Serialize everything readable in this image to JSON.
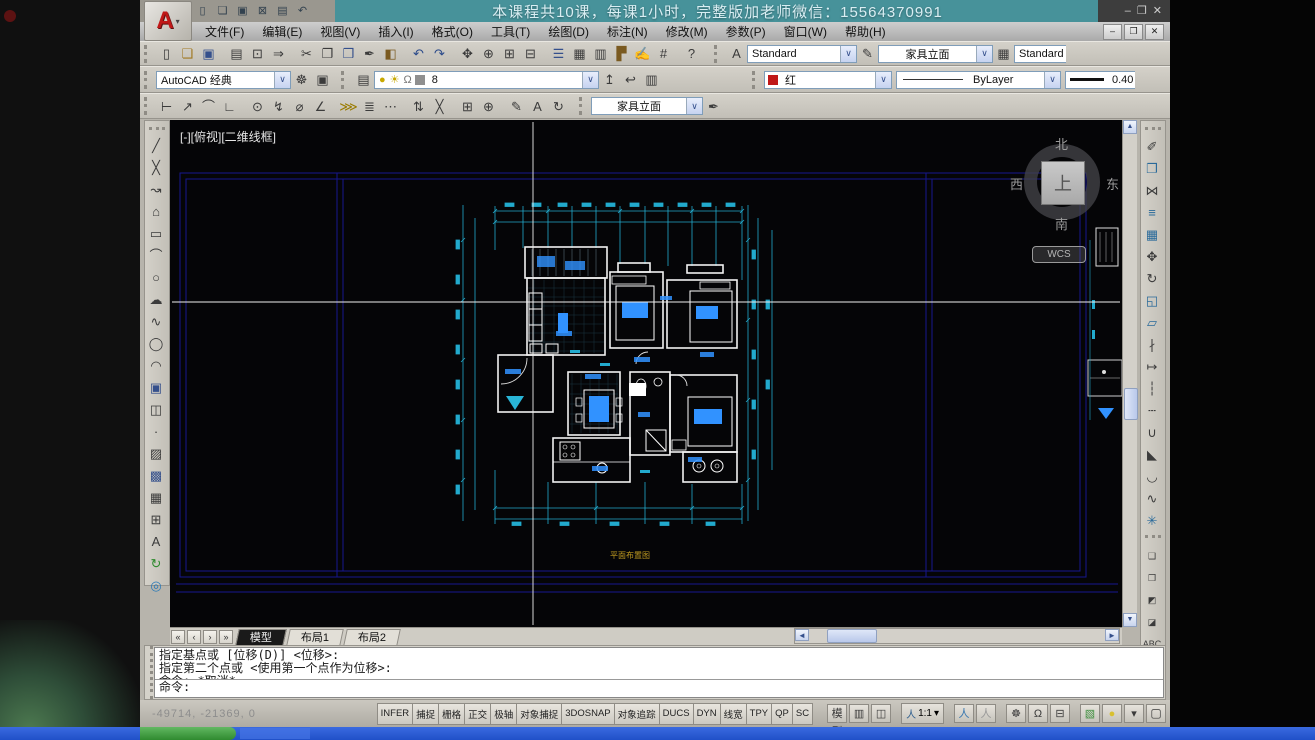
{
  "window": {
    "banner_text": "本课程共10课，每课1小时，完整版加老师微信：15564370991",
    "logo_letter": "A"
  },
  "icons": {
    "min": "–",
    "restore": "❐",
    "close": "✕",
    "combo_arrow": "∨",
    "dropdown": "▾",
    "text_style": "A",
    "dim_style": "✎",
    "table_style": "▦",
    "layer_mgr": "▤",
    "layer_bulb": "●",
    "layer_sun": "☀",
    "layer_lock": "Ω",
    "layer_current": "↥",
    "layer_prev": "↩",
    "layer_states": "▥",
    "workspace_gear": "☸",
    "workspace_save": "▣",
    "dim_style_mgr": "✒",
    "person": "人",
    "scroll_up": "▲",
    "scroll_down": "▼",
    "scroll_left": "◄",
    "scroll_right": "►"
  },
  "menu": {
    "items": [
      {
        "n": "menu-file",
        "t": "文件(F)"
      },
      {
        "n": "menu-edit",
        "t": "编辑(E)"
      },
      {
        "n": "menu-view",
        "t": "视图(V)"
      },
      {
        "n": "menu-insert",
        "t": "插入(I)"
      },
      {
        "n": "menu-format",
        "t": "格式(O)"
      },
      {
        "n": "menu-tools",
        "t": "工具(T)"
      },
      {
        "n": "menu-draw",
        "t": "绘图(D)"
      },
      {
        "n": "menu-dimension",
        "t": "标注(N)"
      },
      {
        "n": "menu-modify",
        "t": "修改(M)"
      },
      {
        "n": "menu-parametric",
        "t": "参数(P)"
      },
      {
        "n": "menu-window",
        "t": "窗口(W)"
      },
      {
        "n": "menu-help",
        "t": "帮助(H)"
      }
    ]
  },
  "qat": {
    "icons": [
      {
        "n": "qat-new-icon",
        "g": "▯"
      },
      {
        "n": "qat-open-icon",
        "g": "❏"
      },
      {
        "n": "qat-save-icon",
        "g": "▣"
      },
      {
        "n": "qat-saveas-icon",
        "g": "⊠"
      },
      {
        "n": "qat-plot-icon",
        "g": "▤"
      },
      {
        "n": "qat-undo-icon",
        "g": "↶"
      }
    ]
  },
  "toolbars": {
    "standard": [
      {
        "n": "new-icon",
        "g": "▯"
      },
      {
        "n": "open-icon",
        "g": "❏",
        "c": "#a07820"
      },
      {
        "n": "save-icon",
        "g": "▣",
        "c": "#35508c"
      },
      {
        "n": "plot-icon",
        "g": "▤",
        "gap": 1
      },
      {
        "n": "plot-preview-icon",
        "g": "⊡"
      },
      {
        "n": "publish-icon",
        "g": "⇒"
      },
      {
        "n": "cut-icon",
        "g": "✂",
        "gap": 1
      },
      {
        "n": "copy-icon",
        "g": "❐"
      },
      {
        "n": "paste-icon",
        "g": "❒",
        "c": "#35508c"
      },
      {
        "n": "match-properties-icon",
        "g": "✒"
      },
      {
        "n": "block-editor-icon",
        "g": "◧",
        "c": "#7a5a20"
      },
      {
        "n": "undo-icon",
        "g": "↶",
        "c": "#2a4a8a",
        "gap": 1
      },
      {
        "n": "redo-icon",
        "g": "↷",
        "c": "#2a4a8a"
      },
      {
        "n": "pan-icon",
        "g": "✥",
        "gap": 1
      },
      {
        "n": "zoom-realtime-icon",
        "g": "⊕"
      },
      {
        "n": "zoom-window-icon",
        "g": "⊞"
      },
      {
        "n": "zoom-previous-icon",
        "g": "⊟"
      },
      {
        "n": "properties-palette-icon",
        "g": "☰",
        "c": "#35508c",
        "gap": 1
      },
      {
        "n": "designcenter-icon",
        "g": "▦"
      },
      {
        "n": "tool-palettes-icon",
        "g": "▥"
      },
      {
        "n": "sheet-set-manager-icon",
        "g": "▛",
        "c": "#7a5a20"
      },
      {
        "n": "markup-sets-icon",
        "g": "✍"
      },
      {
        "n": "quickcalc-icon",
        "g": "#"
      },
      {
        "n": "help-icon",
        "g": "?",
        "gap": 1
      }
    ],
    "dim": [
      {
        "n": "dim-linear-icon",
        "g": "⊢"
      },
      {
        "n": "dim-aligned-icon",
        "g": "↗"
      },
      {
        "n": "dim-arc-length-icon",
        "g": "⌒"
      },
      {
        "n": "dim-ordinate-icon",
        "g": "∟"
      },
      {
        "n": "dim-radius-icon",
        "g": "⊙",
        "gap": 1
      },
      {
        "n": "dim-jogged-icon",
        "g": "↯"
      },
      {
        "n": "dim-diameter-icon",
        "g": "⌀"
      },
      {
        "n": "dim-angular-icon",
        "g": "∠"
      },
      {
        "n": "dim-quick-icon",
        "g": "⋙",
        "c": "#9a7b00",
        "gap": 1
      },
      {
        "n": "dim-baseline-icon",
        "g": "≣"
      },
      {
        "n": "dim-continue-icon",
        "g": "⋯"
      },
      {
        "n": "dim-space-icon",
        "g": "⇅",
        "gap": 1
      },
      {
        "n": "dim-break-icon",
        "g": "╳"
      },
      {
        "n": "dim-tolerance-icon",
        "g": "⊞",
        "gap": 1
      },
      {
        "n": "dim-center-mark-icon",
        "g": "⊕"
      },
      {
        "n": "dim-edit-icon",
        "g": "✎",
        "gap": 1
      },
      {
        "n": "dim-text-edit-icon",
        "g": "A"
      },
      {
        "n": "dim-update-icon",
        "g": "↻"
      }
    ],
    "draw": [
      {
        "n": "line-icon",
        "g": "╱"
      },
      {
        "n": "construction-line-icon",
        "g": "╳"
      },
      {
        "n": "polyline-icon",
        "g": "↝"
      },
      {
        "n": "polygon-icon",
        "g": "⌂"
      },
      {
        "n": "rectangle-icon",
        "g": "▭"
      },
      {
        "n": "arc-icon",
        "g": "⌒"
      },
      {
        "n": "circle-icon",
        "g": "○"
      },
      {
        "n": "revision-cloud-icon",
        "g": "☁"
      },
      {
        "n": "spline-icon",
        "g": "∿"
      },
      {
        "n": "ellipse-icon",
        "g": "◯"
      },
      {
        "n": "ellipse-arc-icon",
        "g": "◠"
      },
      {
        "n": "insert-block-icon",
        "g": "▣",
        "c": "#35508c"
      },
      {
        "n": "make-block-icon",
        "g": "◫"
      },
      {
        "n": "point-icon",
        "g": "·"
      },
      {
        "n": "hatch-icon",
        "g": "▨"
      },
      {
        "n": "gradient-icon",
        "g": "▩",
        "c": "#35508c"
      },
      {
        "n": "region-icon",
        "g": "▦"
      },
      {
        "n": "table-icon",
        "g": "⊞"
      },
      {
        "n": "mtext-icon",
        "g": "A"
      },
      {
        "n": "update-block-icon",
        "g": "↻",
        "c": "#2d8a2d"
      },
      {
        "n": "donut-icon",
        "g": "◎",
        "c": "#2a7ab8"
      }
    ],
    "modify": [
      {
        "n": "erase-icon",
        "g": "✐"
      },
      {
        "n": "copy-object-icon",
        "g": "❐",
        "c": "#2a6a9a"
      },
      {
        "n": "mirror-icon",
        "g": "⋈"
      },
      {
        "n": "offset-icon",
        "g": "≡",
        "c": "#2a6a9a"
      },
      {
        "n": "array-icon",
        "g": "▦",
        "c": "#2a6a9a"
      },
      {
        "n": "move-icon",
        "g": "✥"
      },
      {
        "n": "rotate-icon",
        "g": "↻"
      },
      {
        "n": "scale-icon",
        "g": "◱",
        "c": "#2a6a9a"
      },
      {
        "n": "stretch-icon",
        "g": "▱",
        "c": "#2a6a9a"
      },
      {
        "n": "trim-icon",
        "g": "∤"
      },
      {
        "n": "extend-icon",
        "g": "↦"
      },
      {
        "n": "break-at-point-icon",
        "g": "┆"
      },
      {
        "n": "break-icon",
        "g": "┄"
      },
      {
        "n": "join-icon",
        "g": "∪"
      },
      {
        "n": "chamfer-icon",
        "g": "◣"
      },
      {
        "n": "fillet-icon",
        "g": "◡"
      },
      {
        "n": "blend-curves-icon",
        "g": "∿"
      },
      {
        "n": "explode-icon",
        "g": "✳",
        "c": "#2a6a9a"
      }
    ],
    "draworder": [
      {
        "n": "bring-to-front-icon",
        "g": "❑"
      },
      {
        "n": "send-to-back-icon",
        "g": "❒"
      },
      {
        "n": "bring-above-icon",
        "g": "◩"
      },
      {
        "n": "send-under-icon",
        "g": "◪"
      },
      {
        "n": "text-to-front-icon",
        "g": "ABC",
        "cls": "txt"
      }
    ]
  },
  "styles": {
    "text_style_value": "Standard",
    "dim_style_value": "家具立面",
    "table_style_value": "Standard"
  },
  "workspace": {
    "value": "AutoCAD 经典"
  },
  "layers": {
    "current_layer": "8"
  },
  "props": {
    "color_value": "红",
    "color_hex": "#c01818",
    "linetype_value": "ByLayer",
    "lineweight_value": "0.40"
  },
  "dim": {
    "style_value": "家具立面"
  },
  "viewport": {
    "label": "[-][俯视][二维线框]"
  },
  "viewcube": {
    "north": "北",
    "south": "南",
    "east": "东",
    "west": "西",
    "up": "上",
    "wcs": "WCS"
  },
  "drawing": {
    "plan_title": "平面布置图"
  },
  "tabs": {
    "nav": [
      {
        "n": "tab-first-button",
        "g": "«"
      },
      {
        "n": "tab-prev-button",
        "g": "‹"
      },
      {
        "n": "tab-next-button",
        "g": "›"
      },
      {
        "n": "tab-last-button",
        "g": "»"
      }
    ],
    "items": [
      {
        "n": "tab-model",
        "t": "模型",
        "cls": "active"
      },
      {
        "n": "tab-layout1",
        "t": "布局1"
      },
      {
        "n": "tab-layout2",
        "t": "布局2"
      }
    ]
  },
  "command": {
    "history": [
      "指定基点或 [位移(D)] <位移>:",
      "指定第二个点或 <使用第一个点作为位移>:",
      "命令: *取消*"
    ],
    "prompt": "命令:"
  },
  "statusbar": {
    "coords": "-49714, -21369, 0",
    "scale": "1:1",
    "toggles": [
      {
        "n": "toggle-infer",
        "t": "INFER"
      },
      {
        "n": "toggle-snap",
        "t": "捕捉"
      },
      {
        "n": "toggle-grid",
        "t": "栅格"
      },
      {
        "n": "toggle-ortho",
        "t": "正交"
      },
      {
        "n": "toggle-polar",
        "t": "极轴"
      },
      {
        "n": "toggle-osnap",
        "t": "对象捕捉"
      },
      {
        "n": "toggle-3dosnap",
        "t": "3DOSNAP"
      },
      {
        "n": "toggle-otrack",
        "t": "对象追踪"
      },
      {
        "n": "toggle-ducs",
        "t": "DUCS"
      },
      {
        "n": "toggle-dyn",
        "t": "DYN"
      },
      {
        "n": "toggle-lineweight",
        "t": "线宽"
      },
      {
        "n": "toggle-tpy",
        "t": "TPY"
      },
      {
        "n": "toggle-qp",
        "t": "QP"
      },
      {
        "n": "toggle-sc",
        "t": "SC"
      }
    ],
    "right_a": [
      {
        "n": "model-space-button",
        "g": "模型",
        "cls": "cjk"
      },
      {
        "n": "quick-view-layouts-icon",
        "g": "▥"
      },
      {
        "n": "quick-view-drawings-icon",
        "g": "◫"
      }
    ],
    "right_b": [
      {
        "n": "annotation-visibility-icon",
        "g": "人",
        "c": "#3a78b0",
        "gap": 1
      },
      {
        "n": "annotation-autoscale-icon",
        "g": "人",
        "c": "#9a9a9a"
      },
      {
        "n": "workspace-switch-icon",
        "g": "☸",
        "gap": 1
      },
      {
        "n": "toolbar-lock-icon",
        "g": "Ω"
      },
      {
        "n": "status-menu-icon",
        "g": "⊟"
      },
      {
        "n": "performance-icon",
        "g": "▧",
        "c": "#3f8f3f",
        "gap": 1
      },
      {
        "n": "lightbulb-icon",
        "g": "●",
        "c": "#d8c030"
      },
      {
        "n": "status-dropdown-icon",
        "g": "▾"
      }
    ],
    "clean_screen": {
      "n": "clean-screen-icon",
      "g": "▢"
    }
  }
}
